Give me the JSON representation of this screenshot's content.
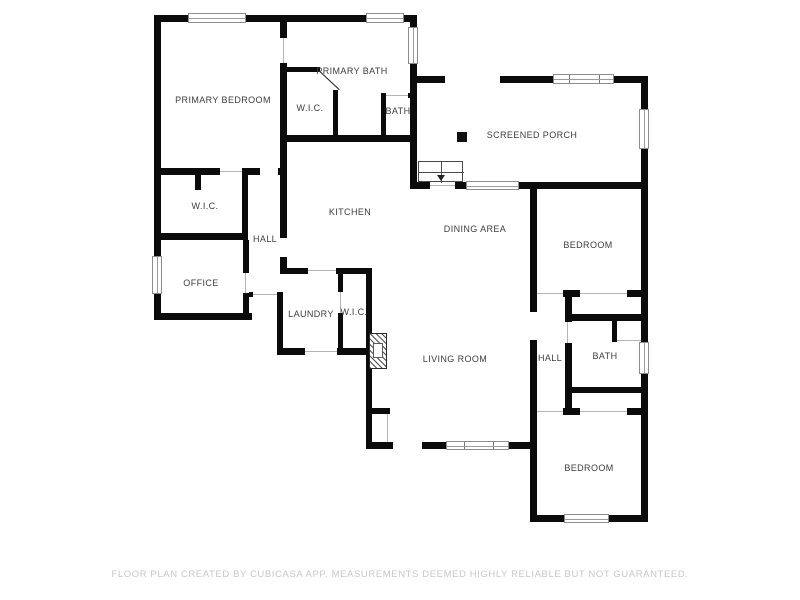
{
  "page": {
    "background": "#ffffff"
  },
  "colors": {
    "wall": "#0b0b0b",
    "room_label": "#3d3d3d",
    "window_frame": "#8d8d8d",
    "footer_text": "#c7c7c7"
  },
  "floor_plan": {
    "rooms": [
      {
        "id": "primary-bedroom",
        "label": "PRIMARY BEDROOM"
      },
      {
        "id": "primary-bath",
        "label": "PRIMARY BATH"
      },
      {
        "id": "wic-primary",
        "label": "W.I.C."
      },
      {
        "id": "bath-primary",
        "label": "BATH"
      },
      {
        "id": "screened-porch",
        "label": "SCREENED PORCH"
      },
      {
        "id": "wic-left",
        "label": "W.I.C."
      },
      {
        "id": "hall-left",
        "label": "HALL"
      },
      {
        "id": "kitchen",
        "label": "KITCHEN"
      },
      {
        "id": "dining-area",
        "label": "DINING AREA"
      },
      {
        "id": "bedroom-right",
        "label": "BEDROOM"
      },
      {
        "id": "office",
        "label": "OFFICE"
      },
      {
        "id": "laundry",
        "label": "LAUNDRY"
      },
      {
        "id": "wic-laundry",
        "label": "W.I.C."
      },
      {
        "id": "living-room",
        "label": "LIVING ROOM"
      },
      {
        "id": "hall-right",
        "label": "HALL"
      },
      {
        "id": "bath-right",
        "label": "BATH"
      },
      {
        "id": "bedroom-bottom",
        "label": "BEDROOM"
      }
    ],
    "symbols": [
      "staircase",
      "stair-direction-arrow",
      "fireplace",
      "porch-post",
      "windows",
      "door-openings"
    ]
  },
  "footer": {
    "disclaimer": "FLOOR PLAN CREATED BY CUBICASA APP. MEASUREMENTS DEEMED HIGHLY RELIABLE BUT NOT GUARANTEED."
  }
}
